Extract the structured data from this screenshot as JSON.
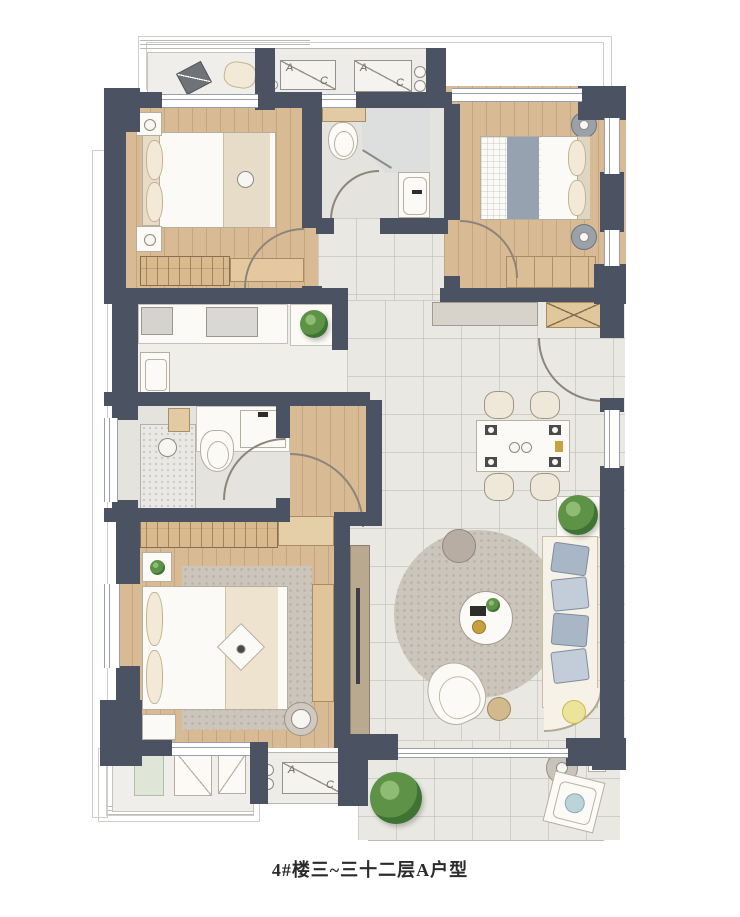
{
  "caption": "4#楼三~三十二层A户型",
  "ac_unit": {
    "letter_a": "A",
    "letter_c": "C"
  },
  "colors": {
    "wall": "#4b5363",
    "wood": "#d8bb94",
    "tile": "#e9e8e3",
    "bath": "#e4e3de",
    "kitchen": "#efeee9",
    "balcony": "#efeeea",
    "rug": "#ccc5bc",
    "sofa_cushion": "#a9b6c6",
    "plant_green": "#5d9247",
    "background": "#ffffff"
  }
}
